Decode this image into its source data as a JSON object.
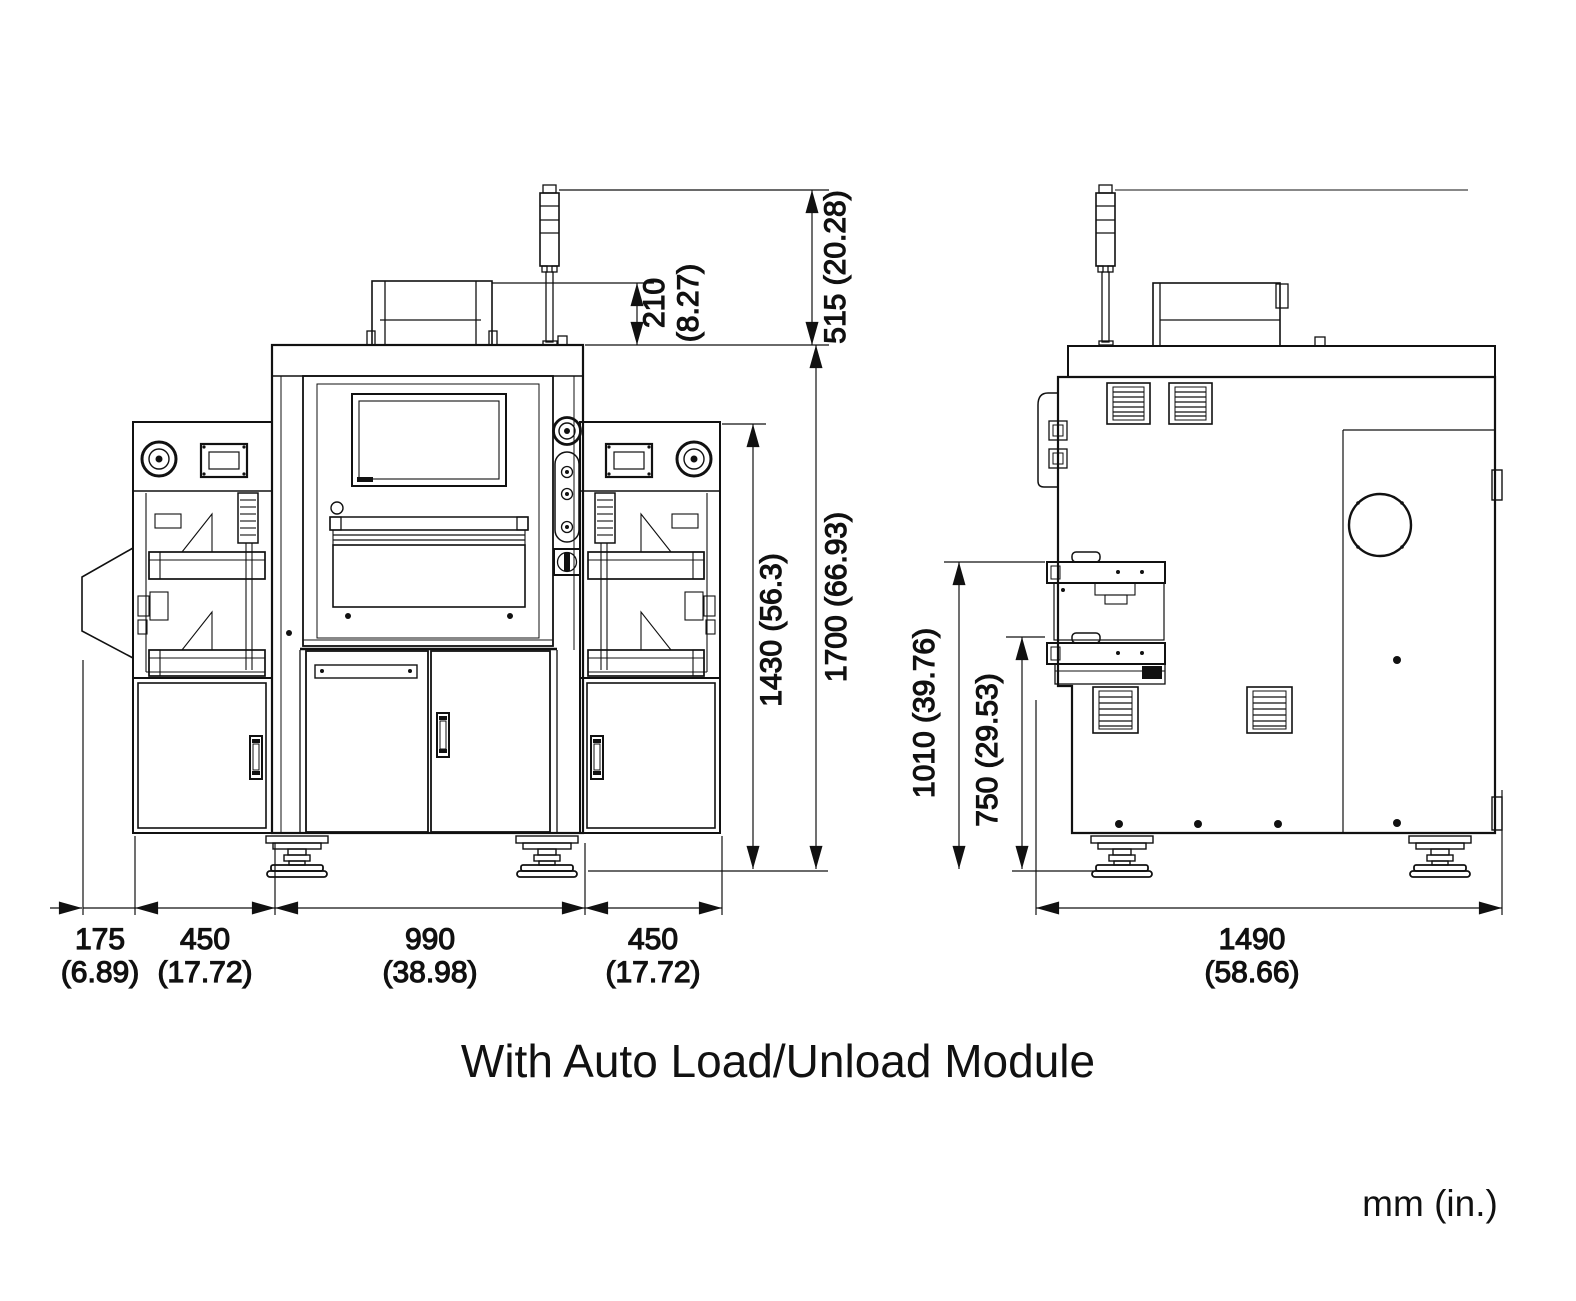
{
  "drawing": {
    "title": "With Auto Load/Unload Module",
    "units_note": "mm (in.)",
    "front_view": {
      "dim_tower_height": "515 (20.28)",
      "dim_roof_box_mm": "210",
      "dim_roof_box_in": "(8.27)",
      "dim_module_height": "1430 (56.3)",
      "dim_total_height": "1700 (66.93)",
      "dim_chute_mm": "175",
      "dim_chute_in": "(6.89)",
      "dim_left_module_mm": "450",
      "dim_left_module_in": "(17.72)",
      "dim_center_mm": "990",
      "dim_center_in": "(38.98)",
      "dim_right_module_mm": "450",
      "dim_right_module_in": "(17.72)"
    },
    "side_view": {
      "dim_upper_port_height": "1010 (39.76)",
      "dim_lower_port_height": "750 (29.53)",
      "dim_depth_mm": "1490",
      "dim_depth_in": "(58.66)"
    }
  }
}
